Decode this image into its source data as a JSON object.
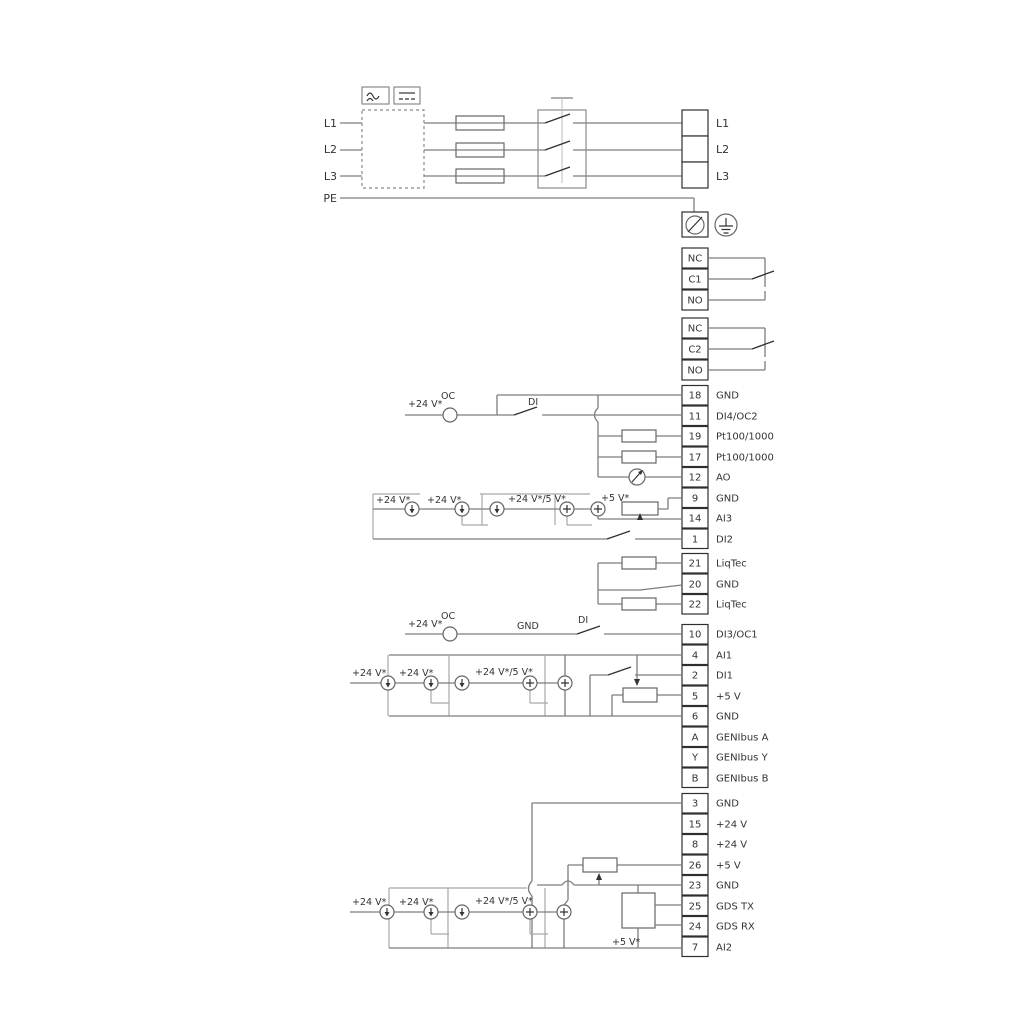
{
  "power": {
    "inputs": [
      "L1",
      "L2",
      "L3",
      "PE"
    ],
    "outputs": [
      "L1",
      "L2",
      "L3"
    ]
  },
  "relay1": {
    "terminals": [
      "NC",
      "C1",
      "NO"
    ]
  },
  "relay2": {
    "terminals": [
      "NC",
      "C2",
      "NO"
    ]
  },
  "strips": {
    "a": {
      "terminals": [
        {
          "no": "18",
          "label": "GND"
        },
        {
          "no": "11",
          "label": "DI4/OC2"
        },
        {
          "no": "19",
          "label": "Pt100/1000"
        },
        {
          "no": "17",
          "label": "Pt100/1000"
        },
        {
          "no": "12",
          "label": "AO"
        },
        {
          "no": "9",
          "label": "GND"
        },
        {
          "no": "14",
          "label": "AI3"
        },
        {
          "no": "1",
          "label": "DI2"
        }
      ]
    },
    "b": {
      "terminals": [
        {
          "no": "21",
          "label": "LiqTec"
        },
        {
          "no": "20",
          "label": "GND"
        },
        {
          "no": "22",
          "label": "LiqTec"
        }
      ]
    },
    "c": {
      "terminals": [
        {
          "no": "10",
          "label": "DI3/OC1"
        },
        {
          "no": "4",
          "label": "AI1"
        },
        {
          "no": "2",
          "label": "DI1"
        },
        {
          "no": "5",
          "label": "+5 V"
        },
        {
          "no": "6",
          "label": "GND"
        },
        {
          "no": "A",
          "label": "GENIbus A"
        },
        {
          "no": "Y",
          "label": "GENIbus Y"
        },
        {
          "no": "B",
          "label": "GENIbus B"
        }
      ]
    },
    "d": {
      "terminals": [
        {
          "no": "3",
          "label": "GND"
        },
        {
          "no": "15",
          "label": "+24 V"
        },
        {
          "no": "8",
          "label": "+24 V"
        },
        {
          "no": "26",
          "label": "+5 V"
        },
        {
          "no": "23",
          "label": "GND"
        },
        {
          "no": "25",
          "label": "GDS TX"
        },
        {
          "no": "24",
          "label": "GDS RX"
        },
        {
          "no": "7",
          "label": "AI2"
        }
      ]
    }
  },
  "labels": {
    "v24": "+24 V*",
    "v24v5": "+24 V*/5 V*",
    "v5": "+5 V*",
    "oc": "OC",
    "di": "DI",
    "gnd": "GND"
  },
  "colors": {
    "wire": "#7d7d7d",
    "ink": "#2f2f2f",
    "faint": "#a8a8a8",
    "background": "#ffffff"
  }
}
